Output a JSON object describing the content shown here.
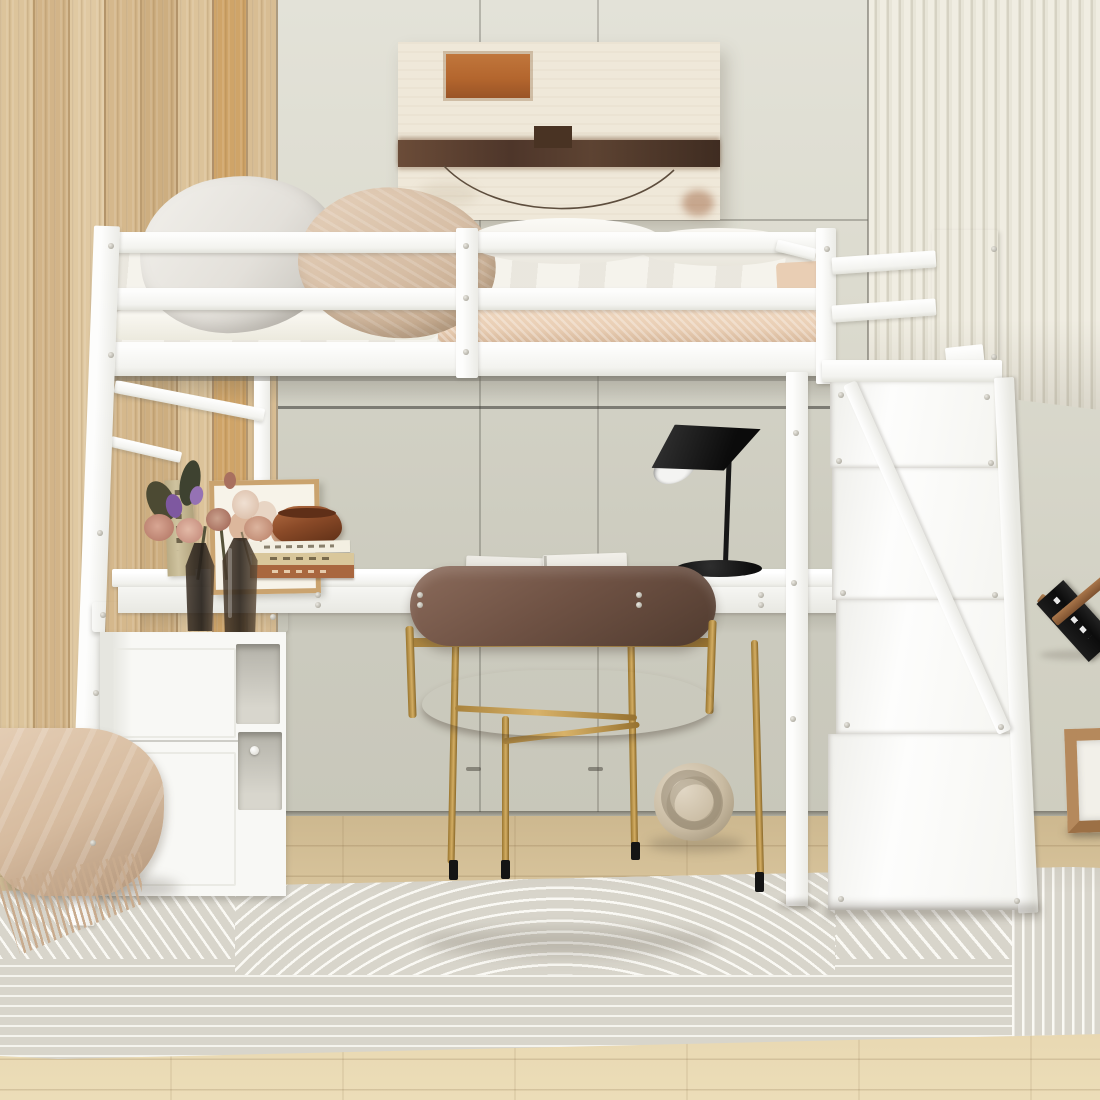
{
  "meta": {
    "description": "Bright bedroom product photo: white loft bed with under-bed desk, left storage cabinet, storage staircase on the right, brown leather chair with gold frame, black desk lamp, abstract wall art, striped area rug on light wood floor"
  },
  "palette": {
    "white": "#fdfdfc",
    "wall": "#dcdbcf",
    "wall_dark": "#cfcec0",
    "wood": "#d6bb90",
    "wood_seam": "#b3946a",
    "rib_face": "#f0ede2",
    "rib_gap": "#d6d2c3",
    "floor_a": "#cdb88f",
    "floor_b": "#ecddb8",
    "rug_base": "#d8d5cb",
    "rug_stripe": "#faf9f4",
    "mattress": "#e9ceb4",
    "duvet": "#f5f3ec",
    "pillow_gray": "#e3e0da",
    "pillow_beige": "#d6bda4",
    "chair": "#6f5244",
    "chair_dark": "#503b2f",
    "gold": "#c59e55",
    "black": "#161616",
    "canvas": "#efe8d9",
    "rust": "#b4662e",
    "band": "#54392a",
    "pot": "#8a4a28",
    "wood_item": "#a9764a",
    "blanket": "#d6bb9f",
    "pouf": "#9a968b",
    "knot": "#c9bba2",
    "glass": "#3c2f26"
  },
  "scene": {
    "objects": [
      {
        "name": "left-wood-plank-wall",
        "color": "#d6bb90"
      },
      {
        "name": "center-panel-wall",
        "color": "#dcdbcf"
      },
      {
        "name": "right-ribbed-slat-panel",
        "color": "#f0ede2"
      },
      {
        "name": "abstract-painting",
        "colors": [
          "#efe8d9",
          "#b4662e",
          "#54392a"
        ]
      },
      {
        "name": "white-loft-bed-frame",
        "color": "#fdfdfc"
      },
      {
        "name": "gray-pillow",
        "color": "#e3e0da"
      },
      {
        "name": "beige-pillow",
        "color": "#d6bda4"
      },
      {
        "name": "white-duvet",
        "color": "#f5f3ec"
      },
      {
        "name": "pink-fitted-sheet",
        "color": "#e9ceb4"
      },
      {
        "name": "under-bed-desk",
        "color": "#fdfdfc"
      },
      {
        "name": "storage-cabinet",
        "color": "#f7f7f4"
      },
      {
        "name": "storage-staircase",
        "color": "#fdfdfc"
      },
      {
        "name": "black-desk-lamp",
        "color": "#161616"
      },
      {
        "name": "brown-leather-chair-gold-frame",
        "colors": [
          "#6f5244",
          "#c59e55"
        ]
      },
      {
        "name": "open-magazine",
        "color": "#eceae4"
      },
      {
        "name": "flower-vases-and-books",
        "colors": [
          "#3c2f26",
          "#c89181",
          "#7e58a0",
          "#a9673f"
        ]
      },
      {
        "name": "brown-ceramic-pot",
        "color": "#8a4a28"
      },
      {
        "name": "knot-floor-pillow",
        "color": "#c9bba2"
      },
      {
        "name": "fringed-throw-on-pouf",
        "colors": [
          "#d6bb9f",
          "#9a968b"
        ]
      },
      {
        "name": "wooden-book-stand-with-black-book",
        "colors": [
          "#a9764a",
          "#121212"
        ]
      },
      {
        "name": "wooden-cube-frame",
        "color": "#b5895c"
      },
      {
        "name": "striped-area-rug",
        "colors": [
          "#d8d5cb",
          "#faf9f4"
        ]
      },
      {
        "name": "light-oak-floor",
        "color": "#ecddb8"
      }
    ]
  }
}
